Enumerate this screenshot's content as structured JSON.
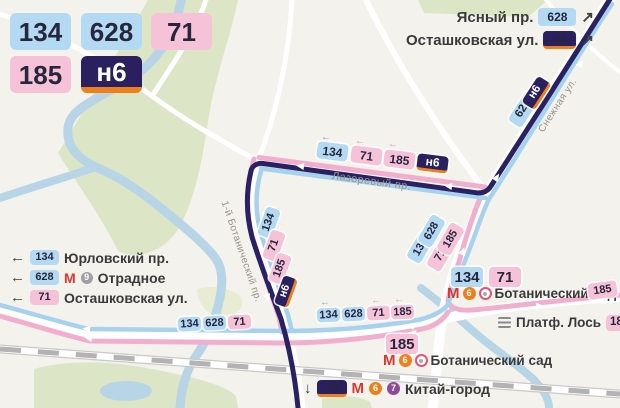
{
  "legend": {
    "routes": [
      {
        "label": "134",
        "style": "blue"
      },
      {
        "label": "628",
        "style": "blue"
      },
      {
        "label": "71",
        "style": "pink"
      },
      {
        "label": "185",
        "style": "pink"
      },
      {
        "label": "н6",
        "style": "night"
      }
    ]
  },
  "arrows": {
    "left": "←",
    "up_right": "↗",
    "right": "→",
    "down": "↓"
  },
  "metro": {
    "logo": "М",
    "line6": "6",
    "line7": "7",
    "line9": "9"
  },
  "streets": {
    "lazorevy": "Лазоревый пр.",
    "botanichesky_1": "1-й Ботанический пр.",
    "snezhnaya": "Снежная ул."
  },
  "top_right_destinations": [
    {
      "name": "Ясный пр.",
      "route": "628"
    },
    {
      "name": "Осташковская ул.",
      "route": "н6"
    }
  ],
  "left_destinations": [
    {
      "route": "134",
      "name": "Юрловский пр."
    },
    {
      "route": "628",
      "name": "Отрадное",
      "metro_line": "9"
    },
    {
      "route": "71",
      "name": "Осташковская ул."
    }
  ],
  "stops": {
    "botanichesky_north": {
      "route_a": "134",
      "route_b": "71",
      "name": "Ботанический сад",
      "through_route": "185"
    },
    "platf_los": {
      "name": "Платф. Лось",
      "route": "185"
    },
    "botanichesky_south": {
      "route": "185",
      "name": "Ботанический сад"
    },
    "kitay_gorod": {
      "route": "н6",
      "name": "Китай-город"
    }
  },
  "map_badges": {
    "snezhnaya": [
      "628",
      "н6"
    ],
    "lazorevy": [
      "134",
      "71",
      "185",
      "н6"
    ],
    "left_road": [
      "134",
      "71",
      "185",
      "н6"
    ],
    "right_road": [
      "134",
      "628",
      "71",
      "185"
    ],
    "bottom_west": [
      "134",
      "628",
      "71"
    ],
    "bottom_mid": [
      "134",
      "628",
      "71",
      "185"
    ]
  },
  "colors": {
    "route_day_blue": "#a6d2ee",
    "route_day_pink": "#f1aecd",
    "route_night": "#2a2163",
    "night_stripe": "#ef7f1a",
    "badge_blue": "#b3daf2",
    "badge_pink": "#f6c2d8",
    "metro_red": "#e0352c",
    "line6": "#ef7f1a",
    "line7": "#8d4a97",
    "line9": "#9fa0a4",
    "mcc_ring": "#e0557a",
    "water": "#b7d5e6",
    "park": "#dce6c6",
    "land": "#f4f2ed",
    "railway": "#b3b3b3"
  }
}
